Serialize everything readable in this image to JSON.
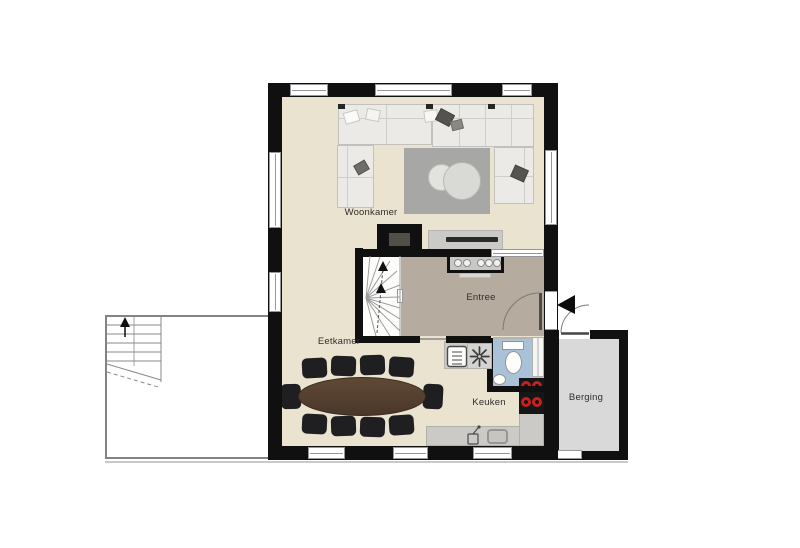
{
  "rooms": {
    "woonkamer": {
      "label": "Woonkamer"
    },
    "eetkamer": {
      "label": "Eetkamer"
    },
    "entree": {
      "label": "Entree"
    },
    "keuken": {
      "label": "Keuken"
    },
    "berging": {
      "label": "Berging"
    }
  },
  "colors": {
    "wall": "#101010",
    "floor_living": "#eae3d0",
    "floor_entree": "#b5ab9f",
    "floor_berging": "#d9d9d9",
    "floor_toilet": "#a9c2da",
    "rug": "#a7a7a5",
    "counter": "#cbcac7",
    "table_wood": "#5a4232",
    "chair_black": "#1f1f21",
    "burner_red": "#c5201d"
  },
  "icons": {
    "stairs_up_arrow": "up",
    "entrance_arrow": "left",
    "ventilation_fan": "fan",
    "washer": "boiler",
    "sink": "sink",
    "cooktop": "4-burner"
  }
}
